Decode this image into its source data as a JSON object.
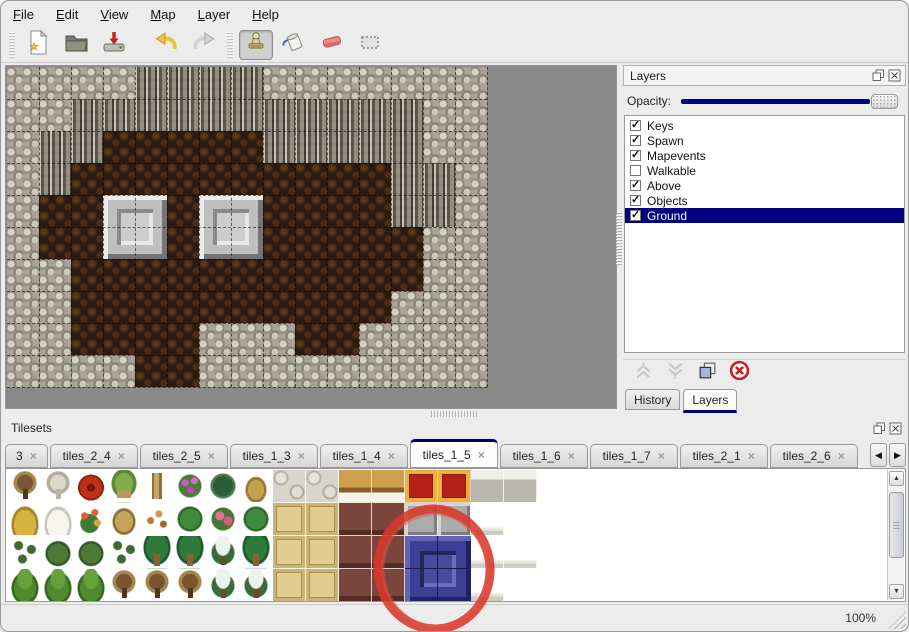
{
  "app": {
    "zoom_status": "100%"
  },
  "menubar": {
    "items": [
      "File",
      "Edit",
      "View",
      "Map",
      "Layer",
      "Help"
    ]
  },
  "toolbar": {
    "buttons": [
      "new-map",
      "open-map",
      "import-map",
      "undo",
      "redo",
      "stamp-tool",
      "fill-tool",
      "eraser-tool",
      "select-tool"
    ],
    "active_tool": "stamp-tool"
  },
  "map": {
    "tile_size": 32,
    "columns": 15,
    "rows": 10,
    "legend": {
      "R": "rock",
      "C": "cliff-wall",
      "F": "cave-floor"
    },
    "grid": [
      "RRRRCCCCRRRRRRR",
      "RRCCCCCCCCCCCRR",
      "RCCFFFFFCCCCCRR",
      "RCFFFFFFFFFFCCR",
      "RFFFFFFFFFFFCCR",
      "RFFFFFFFFFFFFRR",
      "RRFFFFFFFFFFFRR",
      "RRFFFFFFFFFFRRR",
      "RRFFFFRRRFFRRRR",
      "RRRRFFRRRRRRRRR"
    ],
    "pedestals": [
      {
        "col": 3,
        "row": 4,
        "size": 2
      },
      {
        "col": 6,
        "row": 4,
        "size": 2
      }
    ]
  },
  "layers_panel": {
    "title": "Layers",
    "opacity_label": "Opacity:",
    "opacity_percent": 100,
    "layers": [
      {
        "name": "Keys",
        "visible": true,
        "selected": false
      },
      {
        "name": "Spawn",
        "visible": true,
        "selected": false
      },
      {
        "name": "Mapevents",
        "visible": true,
        "selected": false
      },
      {
        "name": "Walkable",
        "visible": false,
        "selected": false
      },
      {
        "name": "Above",
        "visible": true,
        "selected": false
      },
      {
        "name": "Objects",
        "visible": true,
        "selected": false
      },
      {
        "name": "Ground",
        "visible": true,
        "selected": true
      }
    ],
    "buttons": [
      "move-layer-up",
      "move-layer-down",
      "duplicate-layer",
      "delete-layer"
    ],
    "bottom_tabs": [
      {
        "label": "History",
        "active": false
      },
      {
        "label": "Layers",
        "active": true
      }
    ]
  },
  "tilesets_panel": {
    "title": "Tilesets",
    "tabs": [
      {
        "label": "3",
        "active": false
      },
      {
        "label": "tiles_2_4",
        "active": false
      },
      {
        "label": "tiles_2_5",
        "active": false
      },
      {
        "label": "tiles_1_3",
        "active": false
      },
      {
        "label": "tiles_1_4",
        "active": false
      },
      {
        "label": "tiles_1_5",
        "active": true
      },
      {
        "label": "tiles_1_6",
        "active": false
      },
      {
        "label": "tiles_1_7",
        "active": false
      },
      {
        "label": "tiles_2_1",
        "active": false
      },
      {
        "label": "tiles_2_6",
        "active": false
      }
    ],
    "tile_size": 33,
    "legend": {
      "dt": "dead-tree",
      "wt": "white-tree",
      "rf": "red-flower",
      "st": "stump",
      "tk": "trunk",
      "pb": "pink-flower-bush",
      "fn": "fern",
      "dg": "dead-grass",
      "hp": "hay-pile",
      "sp": "snow-pile",
      "of": "orange-flowers",
      "db": "dry-bush",
      "lv": "leaves",
      "lp": "lily-pad",
      "rs": "rose-bush",
      "sg": "sprigs",
      "bu": "bush",
      "pm": "palm-tree",
      "sd": "snowy-tree",
      "pn": "pine-bush",
      "sn": "stone-floor",
      "wd": "wood-table",
      "rc": "red-carpet",
      "gt": "gray-table",
      "tn": "tan-carpet",
      "mr": "maroon-furniture",
      "mt": "metal-block",
      "cl": "white-cloth",
      "wh": "empty-white",
      "bl": "blue-block-selected"
    },
    "grid": [
      [
        "dt",
        "wt",
        "rf",
        "st",
        "tk",
        "pb",
        "fn",
        "dg",
        "sn",
        "sn",
        "wd",
        "wd",
        "rc",
        "rc",
        "gt",
        "gt"
      ],
      [
        "hp",
        "sp",
        "of",
        "db",
        "lv",
        "lp",
        "rs",
        "lp",
        "tn",
        "tn",
        "mr",
        "mr",
        "mt",
        "mt",
        "cl",
        "wh"
      ],
      [
        "sg",
        "bu",
        "bu",
        "sg",
        "pm",
        "pm",
        "sd",
        "pm",
        "tn",
        "tn",
        "mr",
        "mr",
        "bl",
        "bl",
        "cl",
        "cl"
      ],
      [
        "pn",
        "pn",
        "pn",
        "dt",
        "dt",
        "dt",
        "sd",
        "sd",
        "tn",
        "tn",
        "mr",
        "mr",
        "bl",
        "bl",
        "cl",
        "wh"
      ]
    ],
    "selected_tile": {
      "col": 12,
      "row": 2,
      "cols": 2,
      "rows": 2
    },
    "annotation": {
      "type": "hand-drawn-circle",
      "color": "#d8392b"
    }
  },
  "colors": {
    "accent_navy": "#00008b",
    "selection_navy": "#000080",
    "annotation_red": "#d8392b"
  }
}
